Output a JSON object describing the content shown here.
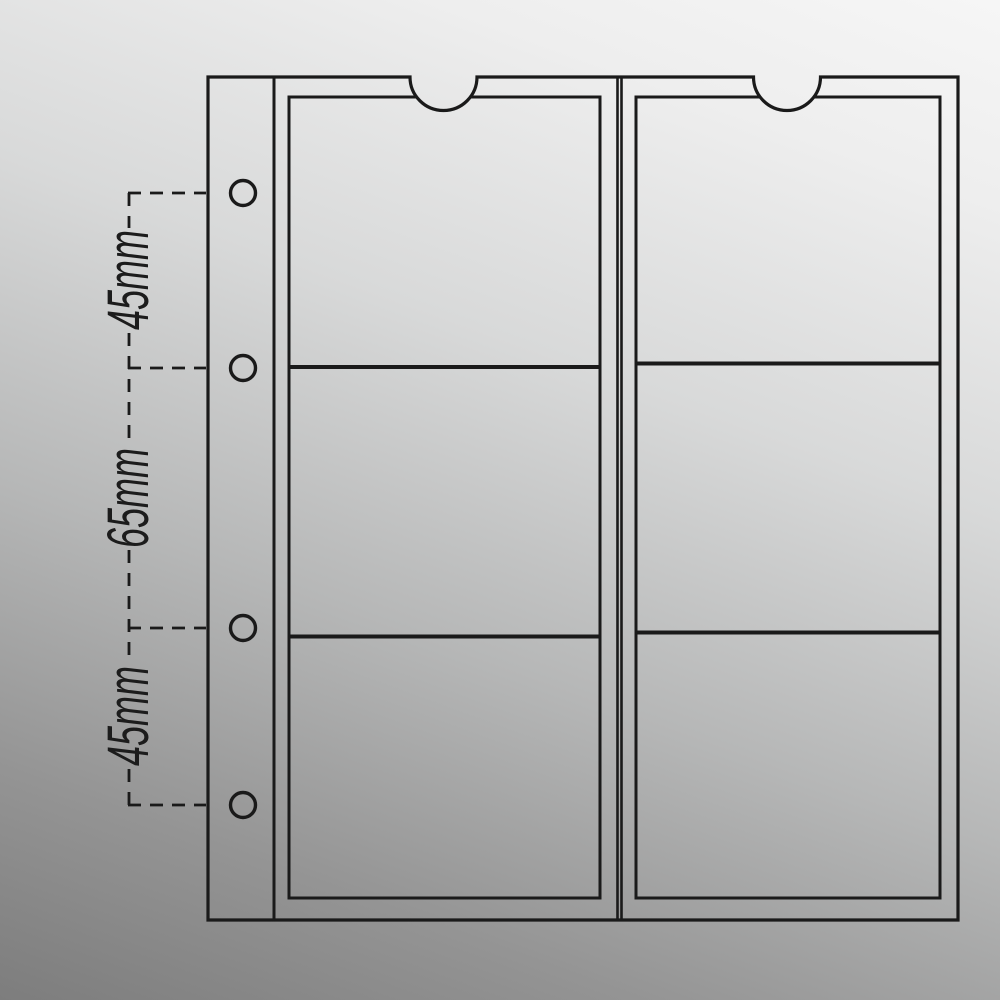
{
  "diagram": {
    "description": "Technical line drawing of a transparent coin-collection album page with two vertical pocket strips of three pockets each, a binder margin with four ring holes, and thumb notches at the top of each strip",
    "line_color": "#1a1a1a",
    "background_top": "#f6f6f6",
    "background_bottom": "#7d7d7d",
    "columns": "2",
    "pockets_per_column": "3",
    "binder_holes": "4"
  },
  "dimensions": [
    {
      "label": "45mm"
    },
    {
      "label": "65mm"
    },
    {
      "label": "45mm"
    }
  ]
}
